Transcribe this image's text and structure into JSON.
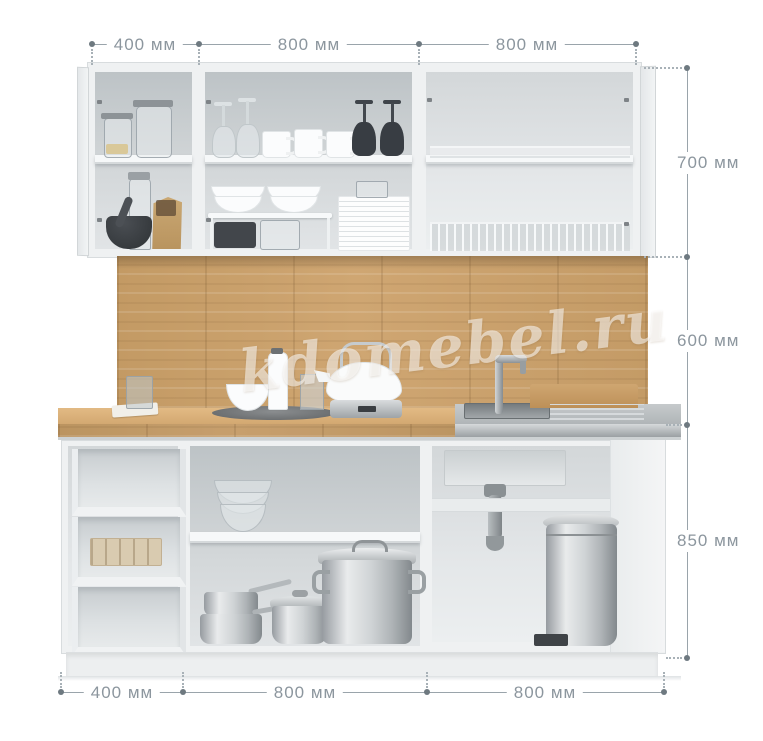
{
  "diagram": {
    "type": "kitchen-set dimension render",
    "watermark": "kdomebel.ru"
  },
  "dimensions": {
    "unit": "мм",
    "top": {
      "labels": [
        "400 мм",
        "800 мм",
        "800 мм"
      ]
    },
    "right": {
      "labels": [
        "700 мм",
        "600 мм",
        "850 мм"
      ]
    },
    "bottom": {
      "labels": [
        "400 мм",
        "800 мм",
        "800 мм"
      ]
    }
  },
  "colors": {
    "dim-line": "#9aa4ab",
    "dim-dot": "#6e7980",
    "dim-text": "#8c969e",
    "wood": "#c79e69",
    "wood-light": "#dcb27b",
    "steel": "#b3b8bb",
    "cabinet": "#eff1f2",
    "cabinet-border": "#d8dcde",
    "interior": "#ccd1d4",
    "dark-item": "#3c4045",
    "watermark-color": "#ffffff8c"
  }
}
